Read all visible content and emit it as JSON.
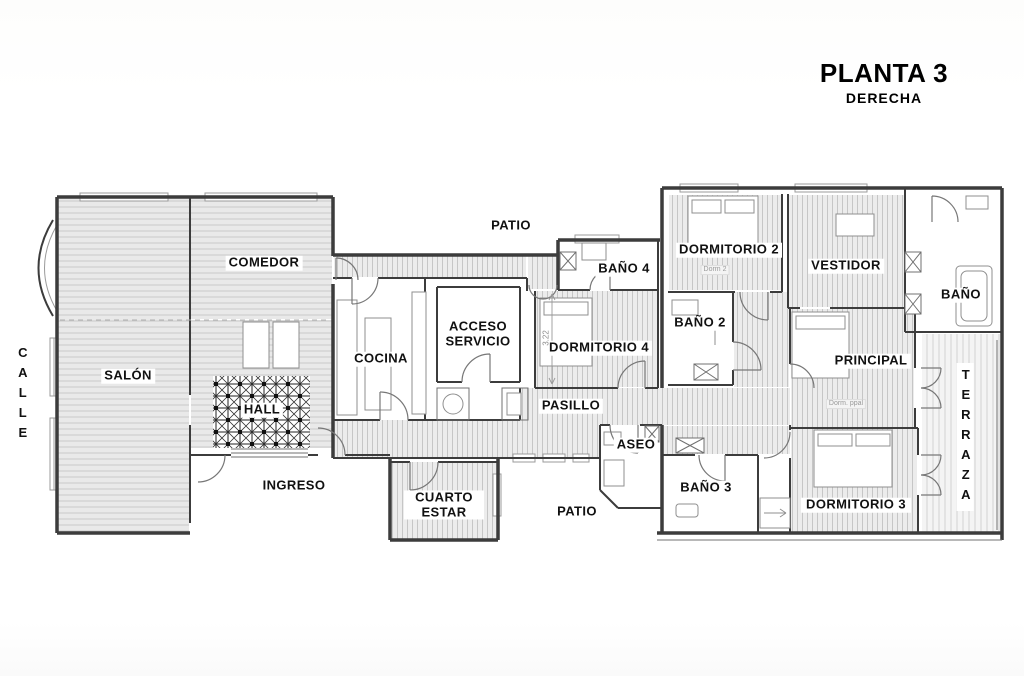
{
  "title": {
    "main": "PLANTA 3",
    "sub": "DERECHA"
  },
  "labels": {
    "calle": "CALLE",
    "salon": "SALÓN",
    "comedor": "COMEDOR",
    "hall": "HALL",
    "ingreso": "INGRESO",
    "cocina": "COCINA",
    "acceso_servicio": "ACCESO SERVICIO",
    "patio_top": "PATIO",
    "patio_bottom": "PATIO",
    "bano4": "BAÑO 4",
    "dormitorio4": "DORMITORIO 4",
    "pasillo": "PASILLO",
    "aseo": "ASEO",
    "dormitorio2": "DORMITORIO 2",
    "dorm2_note": "Dorm 2",
    "bano2": "BAÑO 2",
    "vestidor": "VESTIDOR",
    "bano": "BAÑO",
    "principal": "PRINCIPAL",
    "dorm_ppal_note": "Dorm. ppal",
    "bano3": "BAÑO 3",
    "dormitorio3": "DORMITORIO 3",
    "terraza": "TERRAZA",
    "cuarto_estar": "CUARTO ESTAR"
  },
  "dimensions": {
    "dormitorio4_width_m": "3.22"
  },
  "colors": {
    "wall": "#3c3c3c",
    "floor_fill": "#e9e9e9",
    "hatch_line": "#c9c9c9",
    "label_text": "#111111",
    "note_text": "#999999",
    "background": "#ffffff"
  }
}
